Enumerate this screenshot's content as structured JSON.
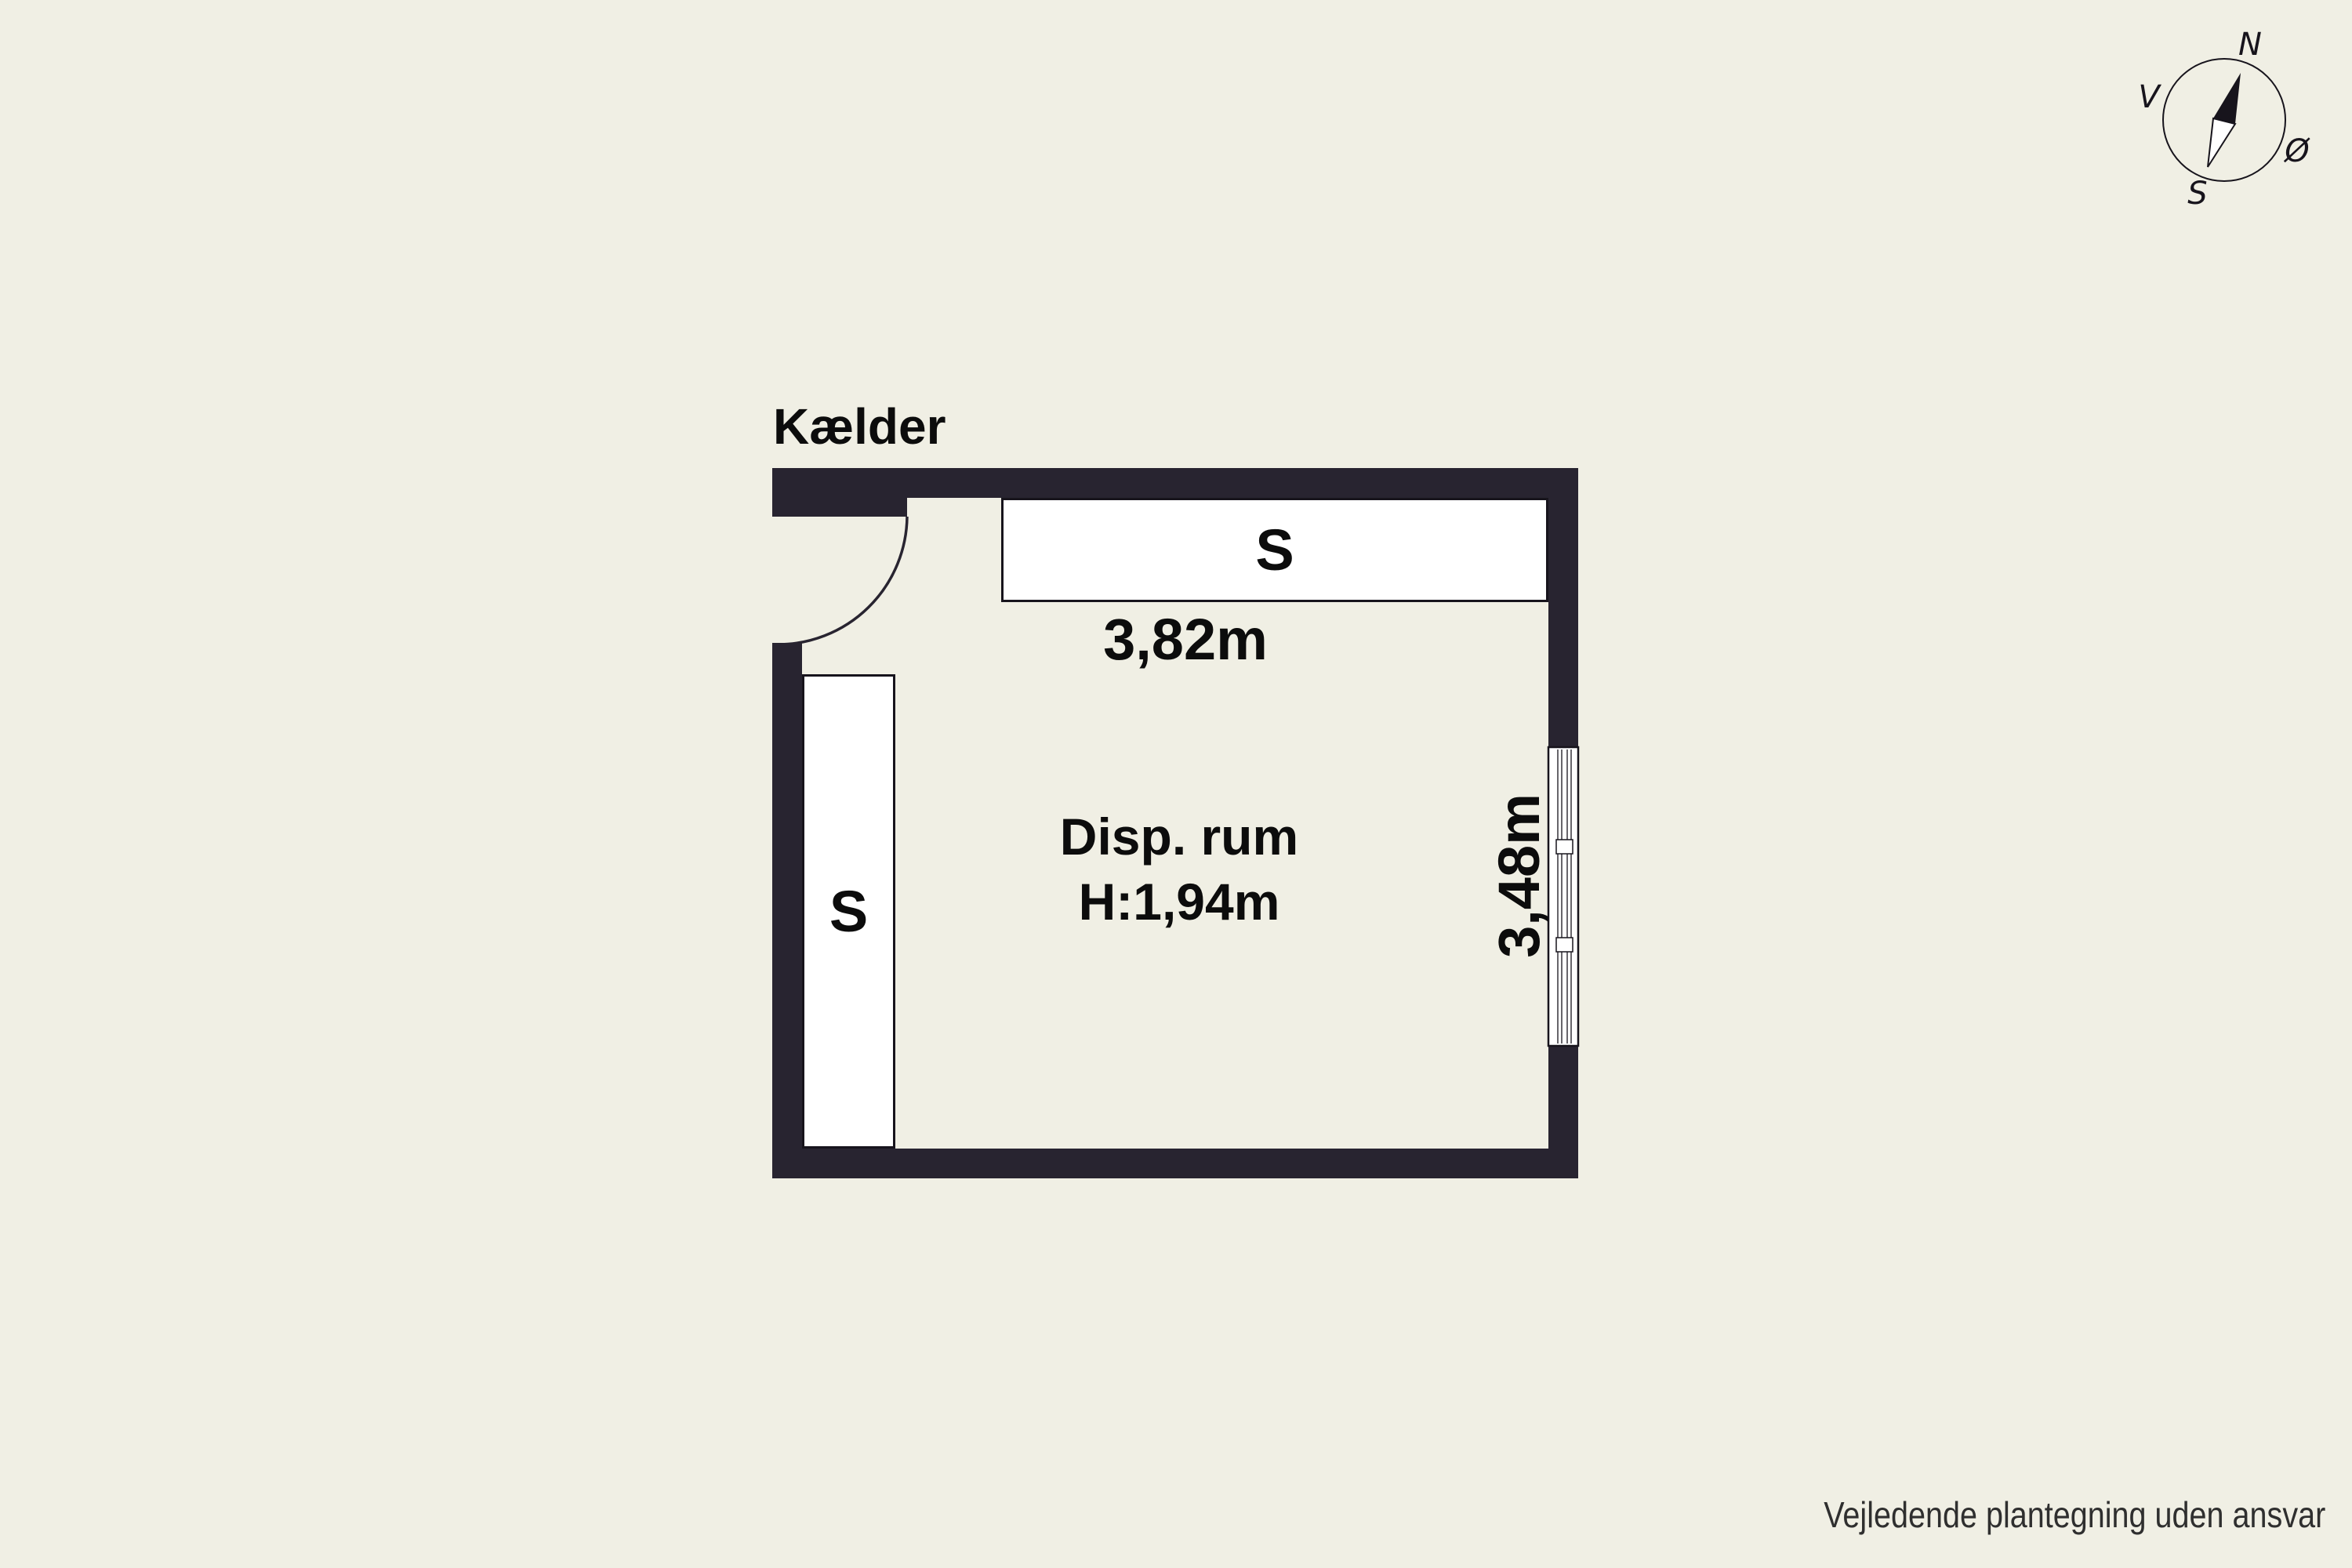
{
  "title": "Kælder",
  "plan": {
    "room_name": "Disp. rum",
    "room_height": "H:1,94m",
    "dim_width": "3,82m",
    "dim_depth": "3,48m",
    "shelf_label": "S",
    "cabinet_label": "S"
  },
  "compass": {
    "north": "N",
    "east": "Ø",
    "south": "S",
    "west": "V"
  },
  "footer": {
    "disclaimer": "Vejledende plantegning uden ansvar"
  },
  "colors": {
    "background": "#f0efe4",
    "wall": "#282430",
    "fixture_fill": "#ffffff",
    "outline": "#17141c",
    "text": "#0c0c0c",
    "disclaimer_text": "#2f2f2f"
  }
}
